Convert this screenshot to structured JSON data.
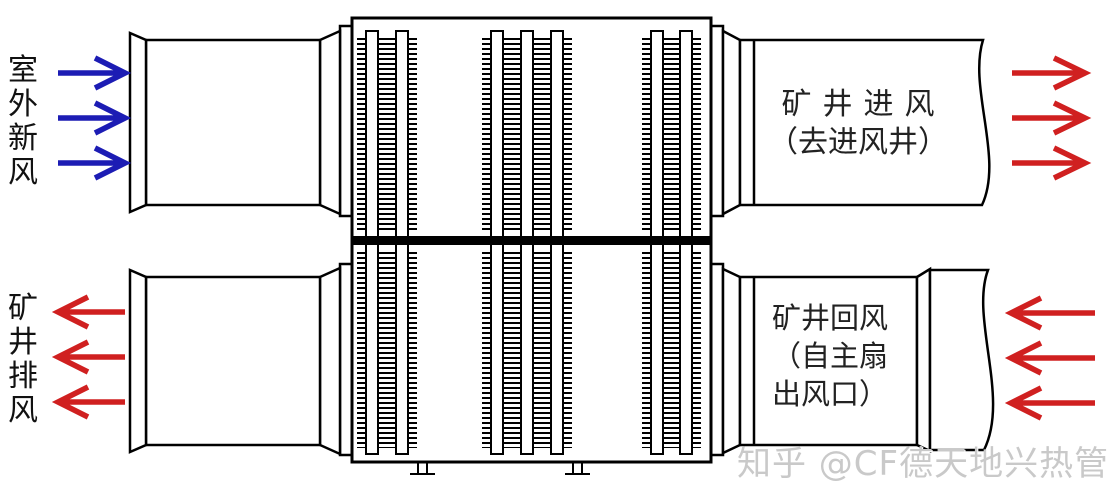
{
  "labels": {
    "outdoor_fresh_air": "室外新风",
    "mine_exhaust_air": "矿井排风"
  },
  "duct_texts": {
    "intake_line1": "矿井进风",
    "intake_line2": "（去进风井）",
    "return_line1": "矿井回风",
    "return_line2": "（自主扇",
    "return_line3": "出风口）"
  },
  "watermark": "知乎 @CF德天地兴热管",
  "arrows": {
    "fresh_air_in": {
      "count": 3,
      "direction": "right",
      "color_name": "blue"
    },
    "mine_intake_out": {
      "count": 3,
      "direction": "right",
      "color_name": "red"
    },
    "mine_exhaust_out": {
      "count": 3,
      "direction": "left",
      "color_name": "red"
    },
    "mine_return_in": {
      "count": 3,
      "direction": "left",
      "color_name": "red"
    }
  },
  "exchanger": {
    "tube_groups": [
      2,
      3,
      2
    ],
    "partition": "black horizontal band"
  },
  "colors": {
    "fresh_air_arrow_blue": "#1c1cb4",
    "hot_air_arrow_red": "#d02020",
    "outline_black": "#000000",
    "watermark_gray": "#c9c9c9"
  }
}
